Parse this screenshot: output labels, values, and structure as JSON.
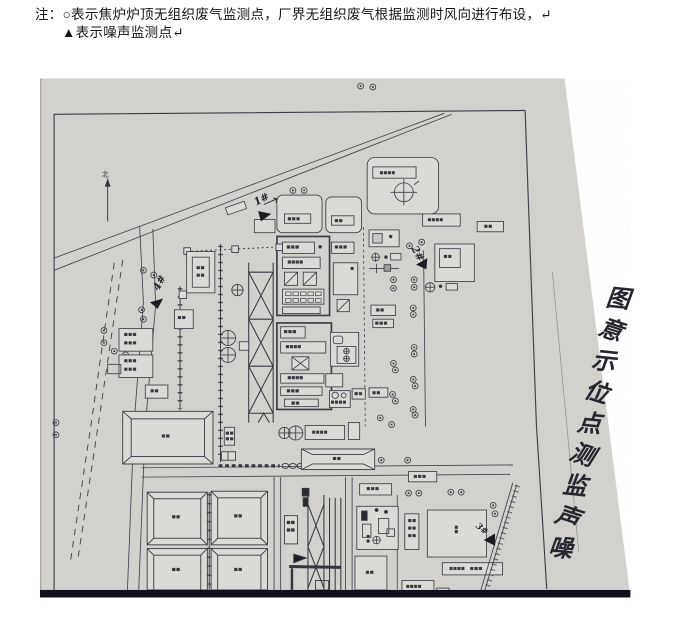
{
  "note": {
    "line1": "注：○表示焦炉炉顶无组织废气监测点，厂界无组织废气根据监测时风向进行布设，↵",
    "line2": "▲表示噪声监测点↵"
  },
  "map": {
    "title": "噪声监测点位示意图",
    "north_label": "北",
    "symbols": {
      "waste_gas_point": "○",
      "noise_point": "▲"
    },
    "noise_points": [
      {
        "id": "1#"
      },
      {
        "id": "2#"
      },
      {
        "id": "3#"
      },
      {
        "id": "4#"
      }
    ],
    "colors": {
      "photo_gray": "#d6d5d1",
      "line_ink": "#3e3e46",
      "photo_edge_dark": "#10101c"
    }
  }
}
